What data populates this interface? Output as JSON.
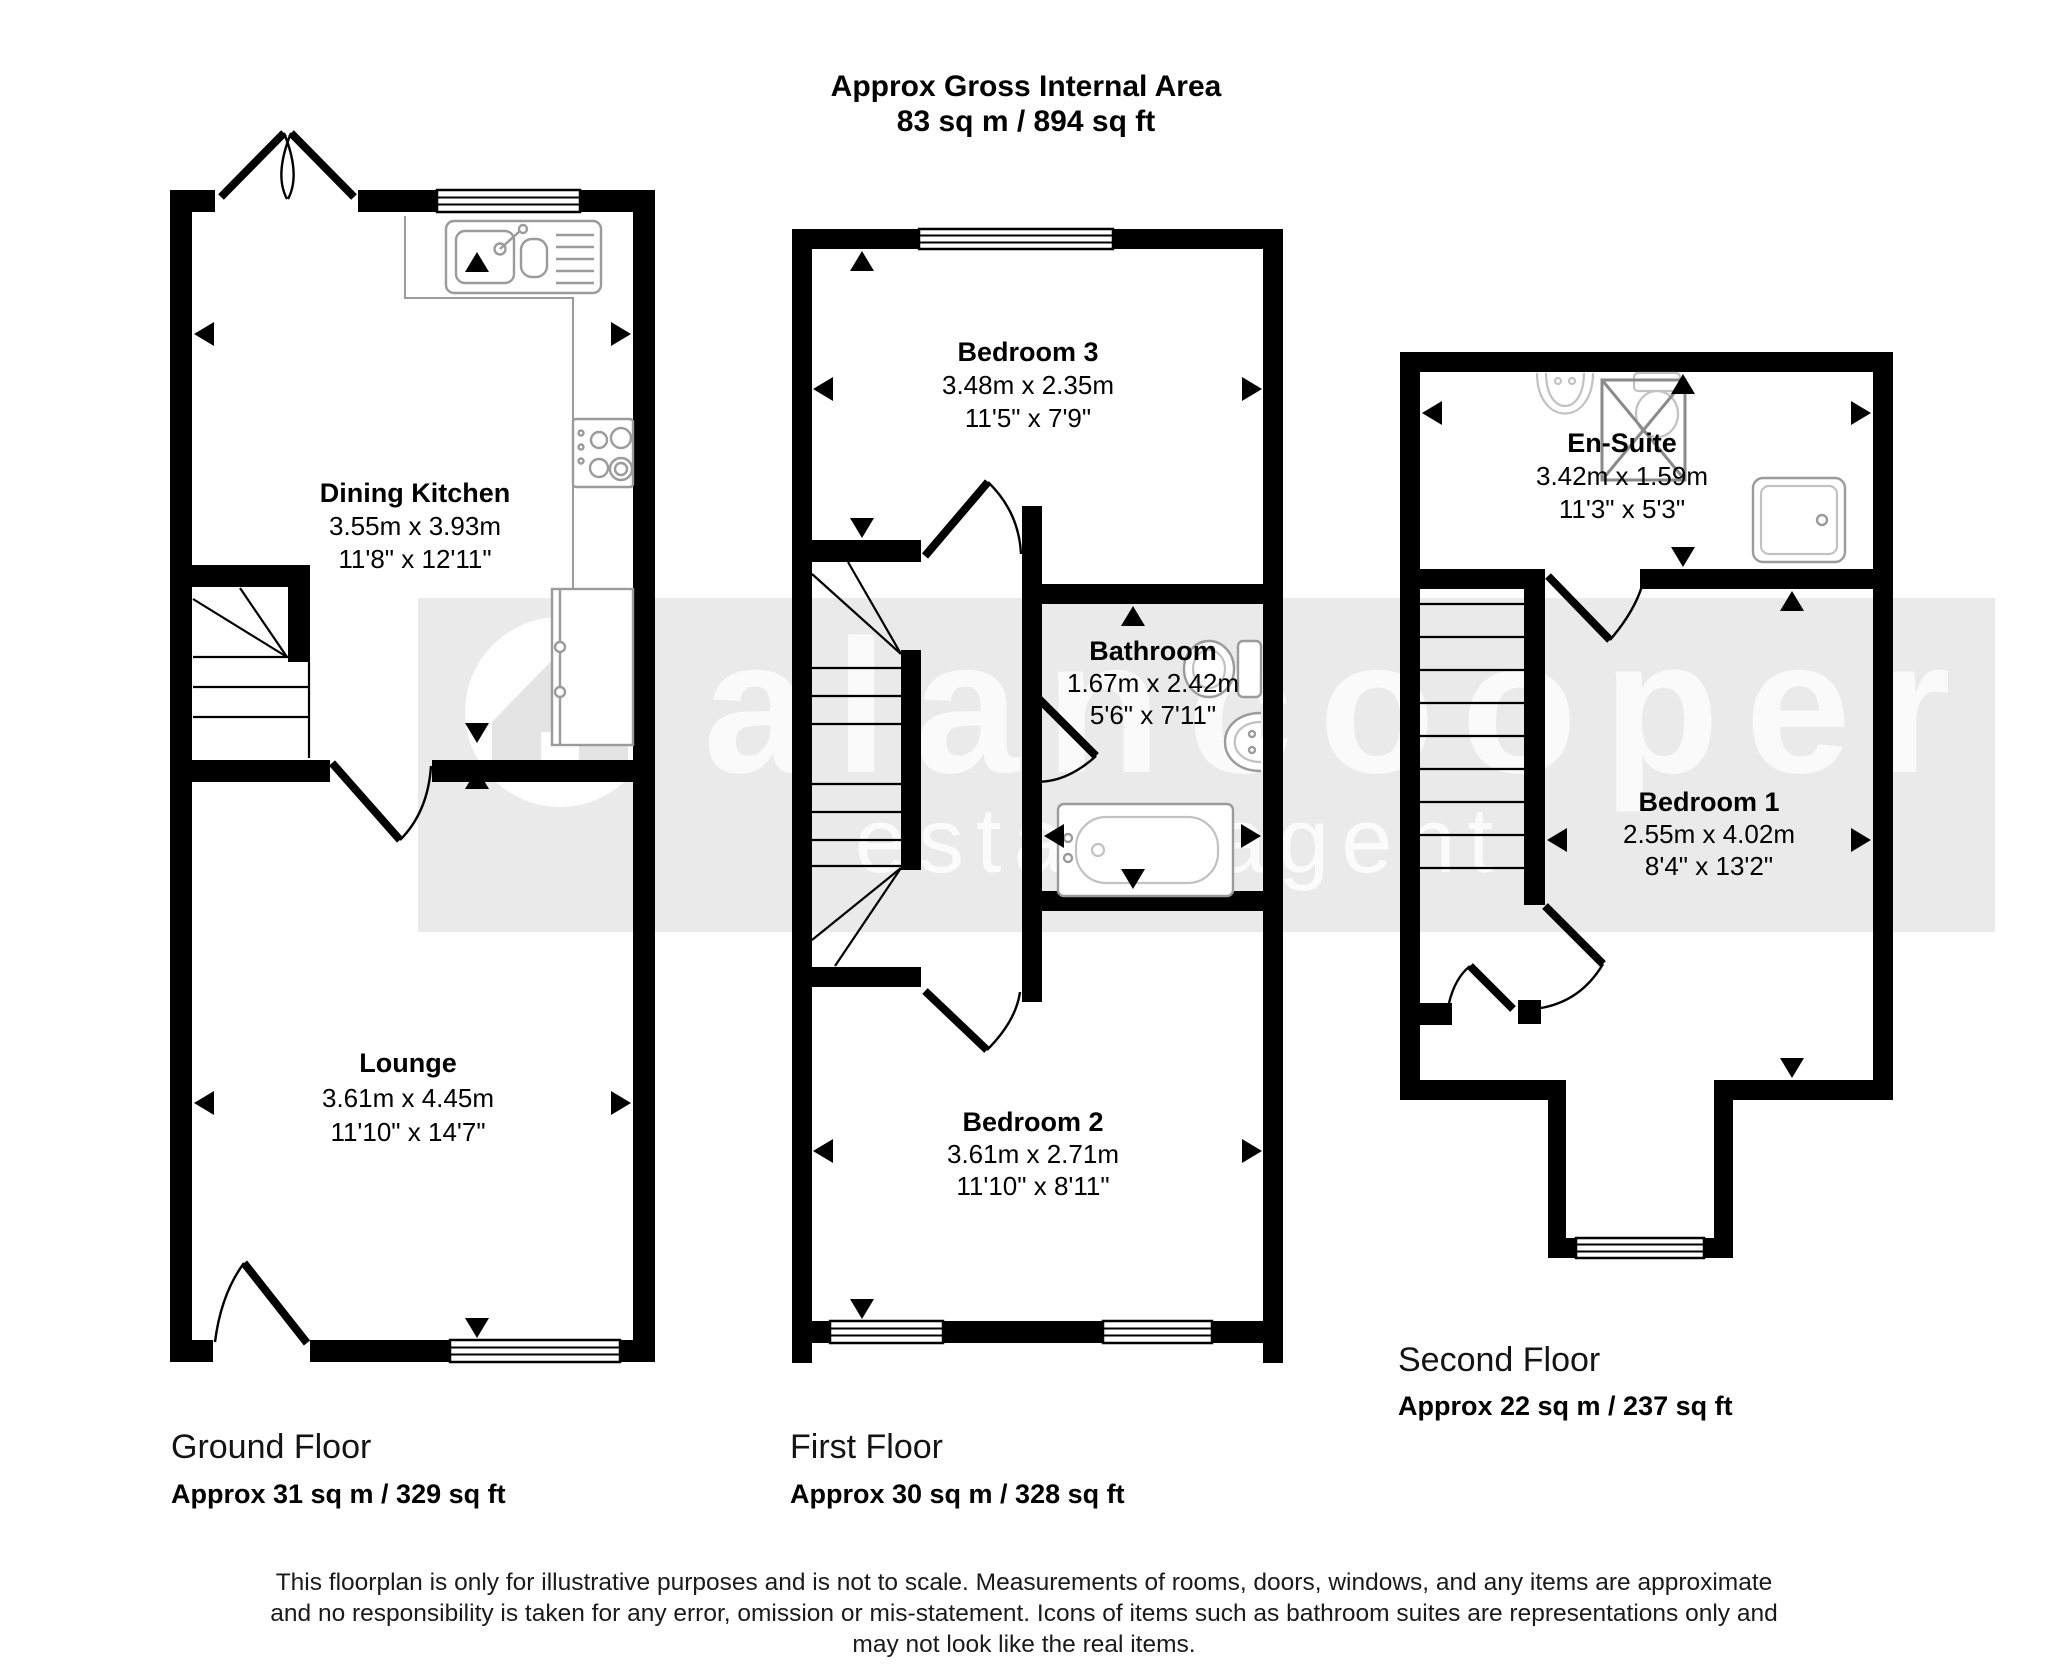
{
  "header": {
    "title": "Approx Gross Internal Area",
    "subtitle": "83 sq m / 894 sq ft"
  },
  "watermark": {
    "brand": "alancooper",
    "tagline": "estate agent"
  },
  "floors": [
    {
      "name": "Ground Floor",
      "area": "Approx 31 sq m / 329 sq ft",
      "rooms": [
        {
          "name": "Dining Kitchen",
          "metric": "3.55m x 3.93m",
          "imperial": "11'8\" x 12'11\""
        },
        {
          "name": "Lounge",
          "metric": "3.61m x 4.45m",
          "imperial": "11'10\" x 14'7\""
        }
      ]
    },
    {
      "name": "First Floor",
      "area": "Approx 30 sq m / 328 sq ft",
      "rooms": [
        {
          "name": "Bedroom 3",
          "metric": "3.48m x 2.35m",
          "imperial": "11'5\" x 7'9\""
        },
        {
          "name": "Bathroom",
          "metric": "1.67m x 2.42m",
          "imperial": "5'6\" x 7'11\""
        },
        {
          "name": "Bedroom 2",
          "metric": "3.61m x 2.71m",
          "imperial": "11'10\" x 8'11\""
        }
      ]
    },
    {
      "name": "Second Floor",
      "area": "Approx 22 sq m / 237 sq ft",
      "rooms": [
        {
          "name": "En-Suite",
          "metric": "3.42m x 1.59m",
          "imperial": "11'3\" x 5'3\""
        },
        {
          "name": "Bedroom 1",
          "metric": "2.55m x 4.02m",
          "imperial": "8'4\" x 13'2\""
        }
      ]
    }
  ],
  "disclaimer": {
    "line1": "This floorplan is only for illustrative purposes and is not to scale. Measurements of rooms, doors, windows, and any items are approximate",
    "line2": "and no responsibility is taken for any error, omission or mis-statement. Icons of items such as bathroom suites are representations only and",
    "line3": "may not look like the real items."
  },
  "icons": {
    "fixtures": [
      "kitchen-sink-icon",
      "hob-icon",
      "fridge-icon",
      "stairs-icon",
      "bath-icon",
      "toilet-icon",
      "basin-icon",
      "shower-icon",
      "rooflight-icon",
      "house-logo-icon"
    ]
  },
  "colors": {
    "wall": "#000000",
    "fixture_stroke": "#9b9b9b",
    "watermark_band": "#eaeaea",
    "page": "#ffffff"
  }
}
